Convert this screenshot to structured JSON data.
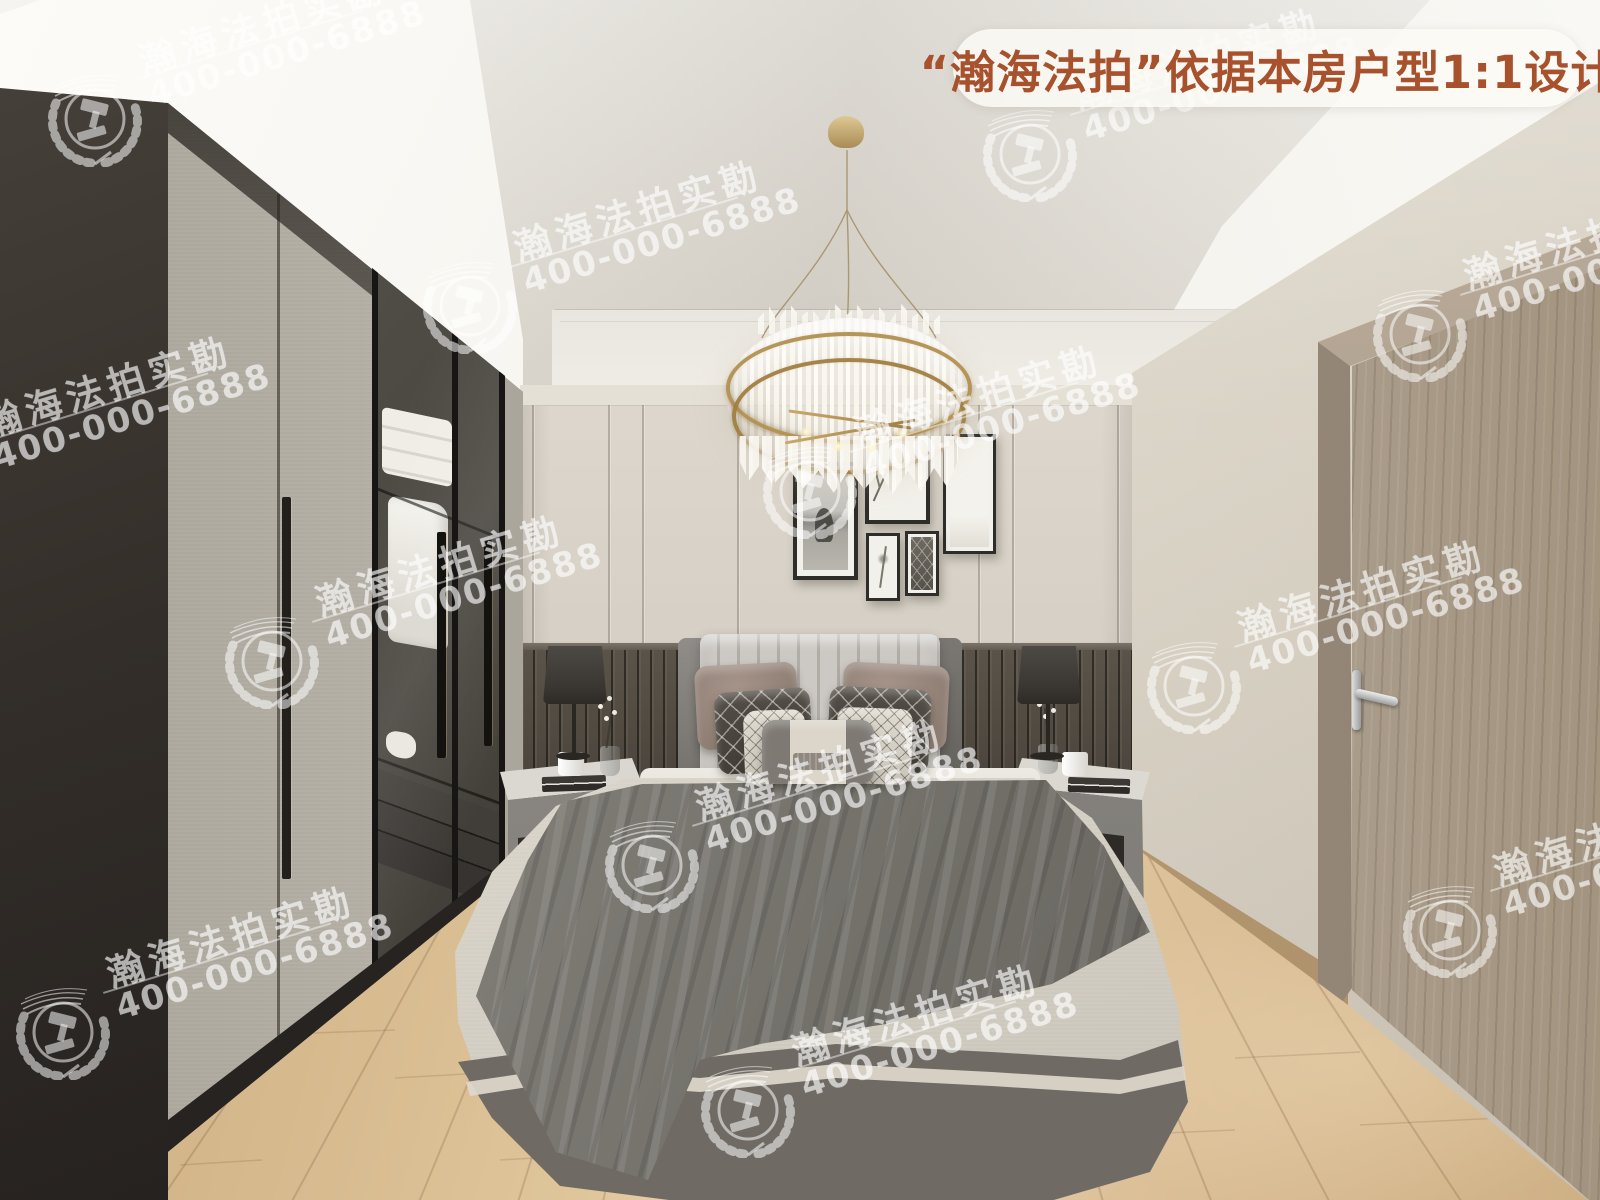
{
  "banner": {
    "text": "“瀚海法拍”依据本房户型1:1设计",
    "text_color": "#a7512d",
    "bg_color": "rgba(252,250,246,0.84)"
  },
  "watermark": {
    "brand": "瀚海法拍实勘",
    "phone": "400-000-6888",
    "color": "rgba(255,255,255,0.58)",
    "logo_icon": "gavel-laurel-badge-icon",
    "rotation_deg": -17,
    "tiles": [
      {
        "x": 95,
        "y": 115
      },
      {
        "x": 470,
        "y": 302
      },
      {
        "x": 1030,
        "y": 150
      },
      {
        "x": 1420,
        "y": 330
      },
      {
        "x": -60,
        "y": 478
      },
      {
        "x": 272,
        "y": 657
      },
      {
        "x": 810,
        "y": 487
      },
      {
        "x": 1194,
        "y": 682
      },
      {
        "x": 652,
        "y": 861
      },
      {
        "x": 1450,
        "y": 926
      },
      {
        "x": 748,
        "y": 1106
      },
      {
        "x": 63,
        "y": 1028
      }
    ]
  },
  "scene_colors": {
    "wall_panel": "#d7d1c7",
    "wainscot": "#4e4840",
    "floor_wood": "#d8bc92",
    "door_wood": "#a6978a",
    "chandelier_gold": "#b2904f",
    "bedspread": "#ded9cf",
    "throw": "#706d67"
  }
}
